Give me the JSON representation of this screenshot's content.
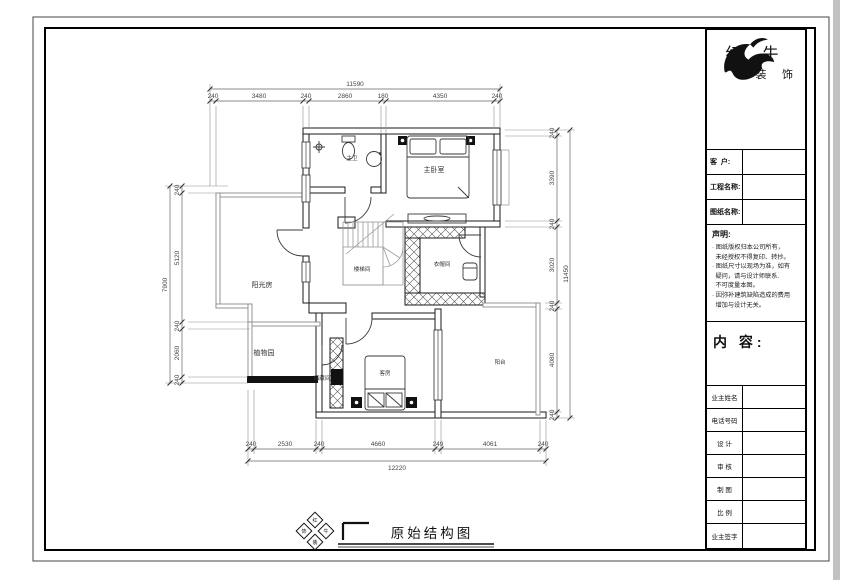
{
  "title_block": {
    "brand_line1": "红 牛",
    "brand_line2": "装 饰",
    "fields": [
      {
        "label": "客  户:"
      },
      {
        "label": "工程名称:"
      },
      {
        "label": "图纸名称:"
      }
    ],
    "statement_heading": "声明:",
    "statement_lines": [
      "· 图纸版权归本公司所有，",
      "  未经授权不得复印、转抄。",
      "· 图纸尺寸以现场为准，如有",
      "  疑问，请与设计师联系.",
      "  不可度量本图。",
      "· 因弥补建筑缺陷造成的费用",
      "  增加与设计无关。"
    ],
    "content_label": "内 容:",
    "info_rows": [
      {
        "label": "业主姓名"
      },
      {
        "label": "电话号码"
      },
      {
        "label": "设 计"
      },
      {
        "label": "审 核"
      },
      {
        "label": "制 图"
      },
      {
        "label": "比 例"
      },
      {
        "label": "业主签字"
      }
    ]
  },
  "plan": {
    "rooms": [
      {
        "label": "主卫"
      },
      {
        "label": "主卧室"
      },
      {
        "label": "楼梯间"
      },
      {
        "label": "衣帽间"
      },
      {
        "label": "阳光房"
      },
      {
        "label": "植物园"
      },
      {
        "label": "储藏间"
      },
      {
        "label": "客房"
      },
      {
        "label": "阳台"
      }
    ]
  },
  "dims": {
    "top": {
      "overall": "11590",
      "segments": [
        "240",
        "3480",
        "240",
        "2860",
        "180",
        "4350",
        "240"
      ]
    },
    "bottom": {
      "overall": "12220",
      "segments": [
        "240",
        "2530",
        "240",
        "4660",
        "249",
        "4061",
        "240"
      ]
    },
    "left": {
      "overall": "7900",
      "segments": [
        "240",
        "5120",
        "240",
        "2060",
        "240"
      ]
    },
    "right": {
      "overall": "11450",
      "segments": [
        "240",
        "3390",
        "240",
        "3020",
        "240",
        "4080",
        "240"
      ]
    }
  },
  "footer": {
    "drawing_title": "原始结构图",
    "stamp_chars": [
      "红",
      "牛",
      "装",
      "饰"
    ]
  }
}
